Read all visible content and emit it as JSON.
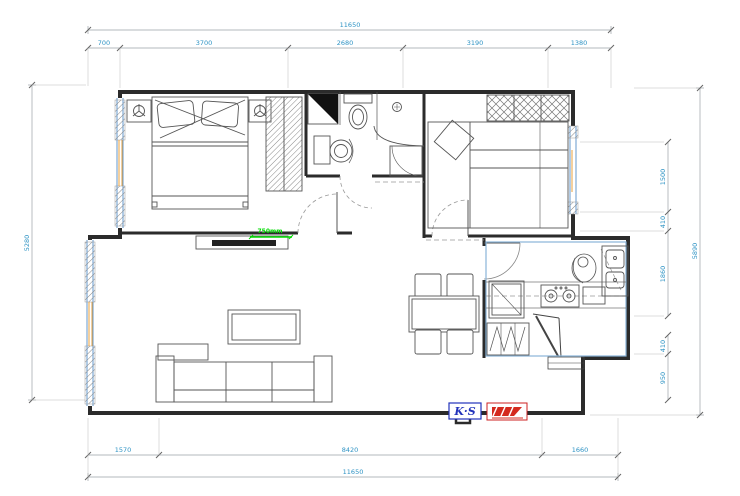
{
  "drawing": {
    "type": "apartment-floor-plan",
    "style": "CAD line drawing"
  },
  "colors": {
    "wall": "#2b2b2b",
    "furniture": "#555555",
    "dimension_line": "#9aa0a6",
    "dimension_text": "#2E93C4",
    "window_blue": "#6699CC",
    "window_orange": "#E8A13C",
    "kitchen_outline": "#8AB4D8",
    "annotation_green": "#00DD00",
    "logo_blue": "#2233BB",
    "logo_red": "#D42A1E",
    "fill_black": "#111111"
  },
  "dimensions": {
    "top": {
      "overall": "11650",
      "segments": [
        "700",
        "3700",
        "2680",
        "3190",
        "1380"
      ]
    },
    "bottom": {
      "overall": "11650",
      "segments": [
        "1570",
        "8420",
        "1660"
      ]
    },
    "left": {
      "overall": "5280"
    },
    "right": {
      "overall": "5890",
      "segments": [
        "1500",
        "410",
        "1860",
        "410",
        "950"
      ]
    }
  },
  "annotations": {
    "green_label": "750mm"
  },
  "logos": {
    "ks_label": "K·S"
  }
}
